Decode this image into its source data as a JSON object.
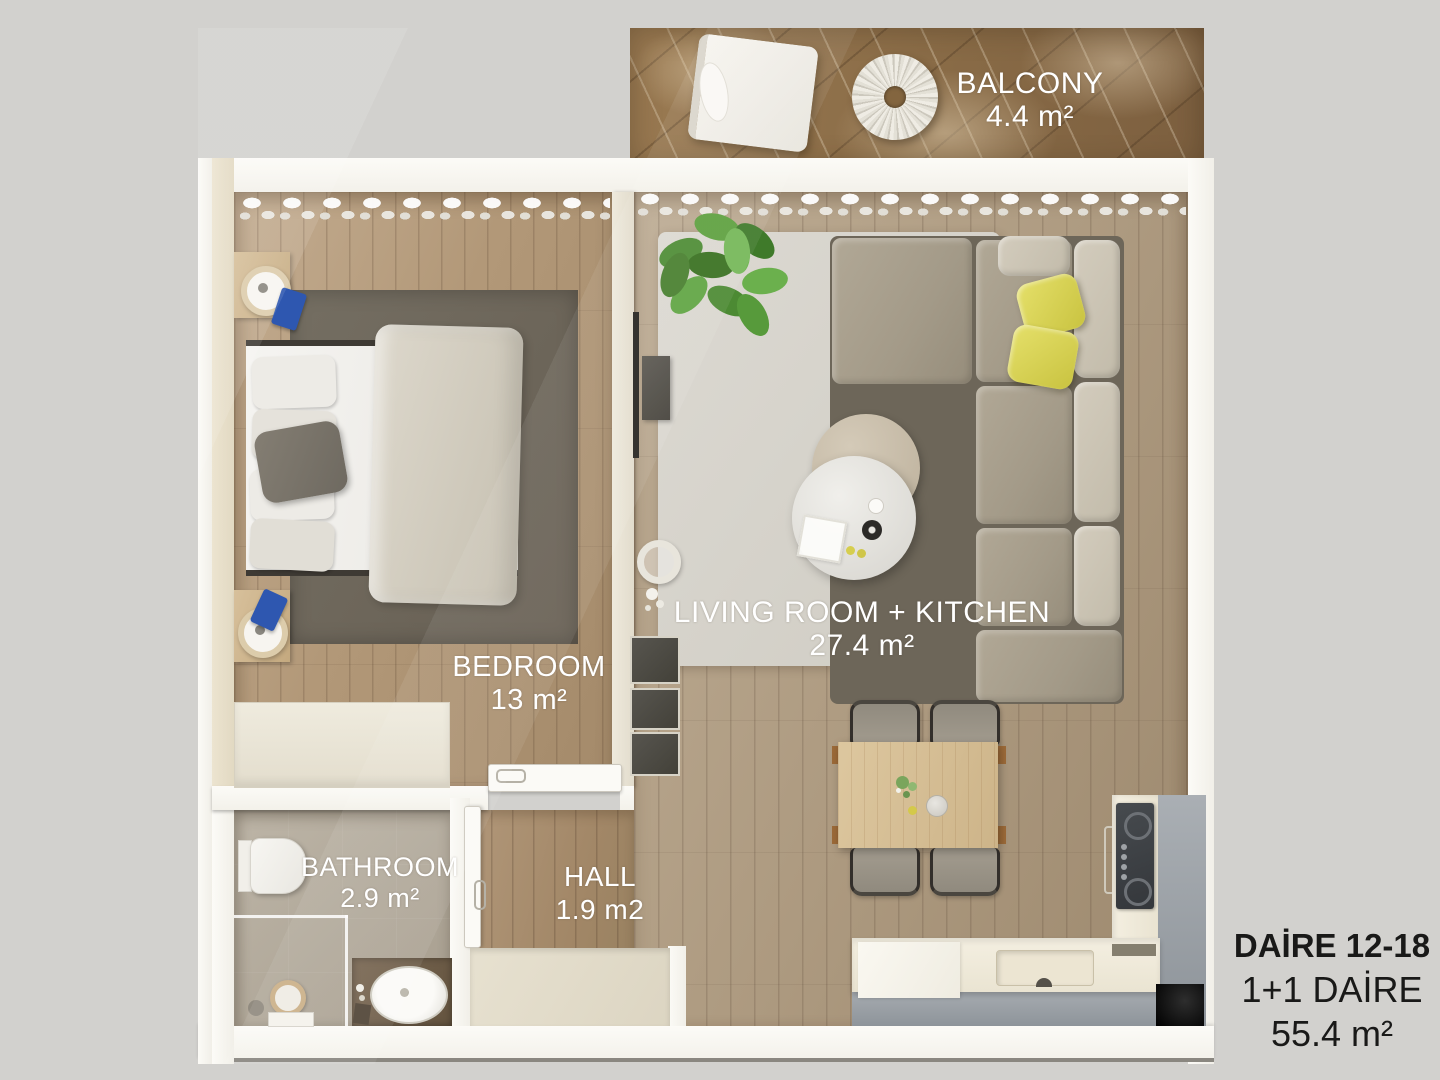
{
  "rooms": {
    "balcony": {
      "name": "BALCONY",
      "area": "4.4 m²"
    },
    "bedroom": {
      "name": "BEDROOM",
      "area": "13 m²"
    },
    "living": {
      "name": "LIVING ROOM + KITCHEN",
      "area": "27.4 m²"
    },
    "bathroom": {
      "name": "BATHROOM",
      "area": "2.9 m²"
    },
    "hall": {
      "name": "HALL",
      "area": "1.9 m2"
    }
  },
  "title_block": {
    "unit": "DAİRE 12-18",
    "type": "1+1 DAİRE",
    "total_area": "55.4 m²"
  },
  "colors": {
    "background": "#d2d1ce",
    "wall_white": "#fbfaf6",
    "wall_beige": "#e7dfcc",
    "wood_floor": "#b29878",
    "balcony_marble": "#8a6c47",
    "bedroom_rug": "#6f695e",
    "living_rug": "#d6d3cb",
    "sofa": "#a39a88",
    "accent_pillow_yellow": "#d9d355",
    "kitchen_counter": "#f1ecdd",
    "kitchen_floor": "#9aa1a8",
    "bathroom_tile": "#b1a99b",
    "label_text": "#ffffff",
    "title_text": "#191918"
  }
}
